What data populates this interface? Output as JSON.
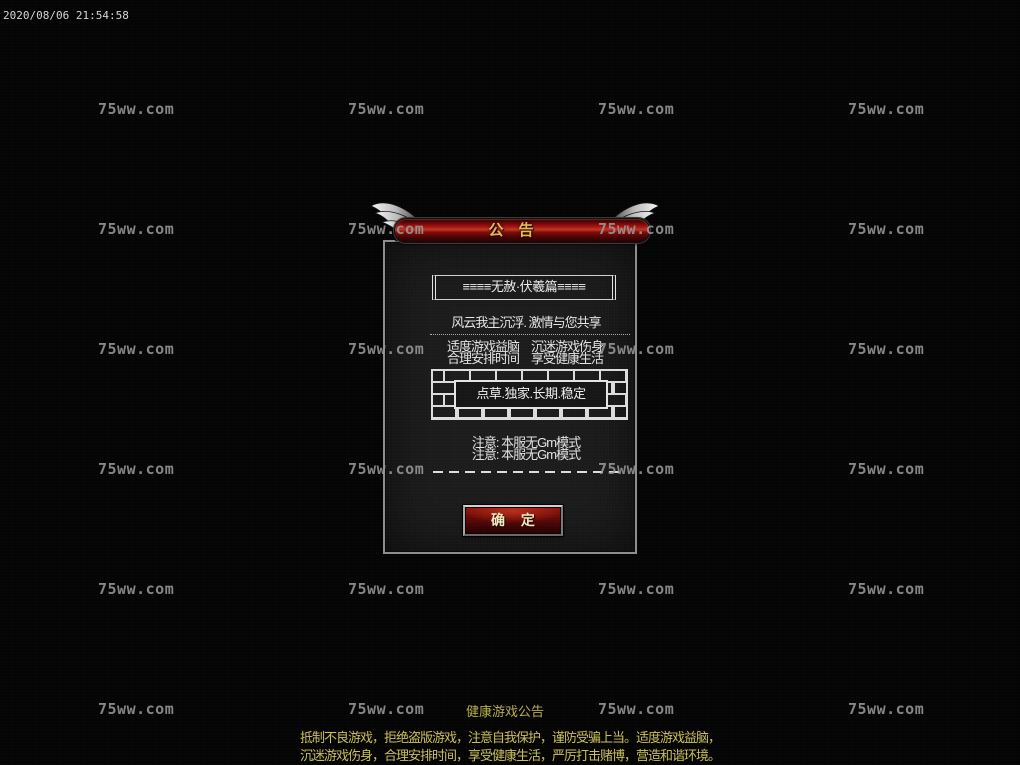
{
  "screen": {
    "timestamp": "2020/08/06 21:54:58"
  },
  "watermark": {
    "text": "75ww.com"
  },
  "dialog": {
    "title": "公　告",
    "server_title": "≡≡≡≡无赦·伏羲篇≡≡≡≡",
    "slogan": "风云我主沉浮. 激情与您共享",
    "health_line1": "适度游戏益脑　沉迷游戏伤身",
    "health_line2": "合理安排时间　享受健康生活",
    "brick_text": "点草.独家.长期.稳定",
    "notice_line1": "注意: 本服无Gm模式",
    "notice_line2": "注意: 本服无Gm模式",
    "confirm_label": "确 定"
  },
  "footer": {
    "health_title": "健康游戏公告",
    "line1": "抵制不良游戏，拒绝盗版游戏，注意自我保护，谨防受骗上当。适度游戏益脑，",
    "line2": "沉迷游戏伤身，合理安排时间，享受健康生活，严厉打击赌博，营造和谐环境。"
  },
  "colors": {
    "header_red": "#a31111",
    "title_gold": "#e6ba50",
    "dialog_bg": "#1c1c1c",
    "dialog_border": "#8e8e8e",
    "button_red": "#8f130d",
    "button_text": "#f3e9bd",
    "footer_yellow": "#c9c05a",
    "watermark_gray": "#989898"
  }
}
